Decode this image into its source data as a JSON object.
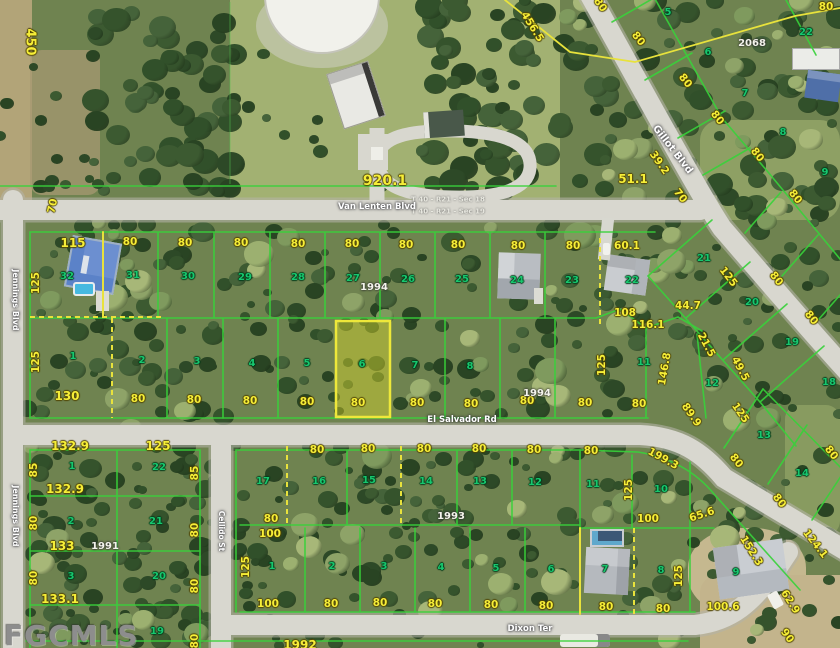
{
  "watermark": "FGCMLS",
  "colors": {
    "dimension": "#f6ee38",
    "lot_number": "#17c76e",
    "plat_line_green": "#38d23a",
    "plat_line_yellow": "#e8e23c",
    "road": "#d8d7cf",
    "highlight_fill": "#e1dc28"
  },
  "streets": [
    {
      "name": "Van Lenten Blvd",
      "labels": [
        {
          "x": 377,
          "y": 207,
          "r": 0,
          "s": 8.5
        }
      ]
    },
    {
      "name": "Gillot Blvd",
      "labels": [
        {
          "x": 672,
          "y": 150,
          "r": 52,
          "s": 10
        }
      ]
    },
    {
      "name": "Jennings Blvd",
      "labels": [
        {
          "x": 15,
          "y": 300,
          "r": 90,
          "s": 8
        },
        {
          "x": 15,
          "y": 516,
          "r": 90,
          "s": 8
        }
      ]
    },
    {
      "name": "Cellido St",
      "labels": [
        {
          "x": 221,
          "y": 531,
          "r": 90,
          "s": 7.5
        }
      ]
    },
    {
      "name": "El Salvador Rd",
      "labels": [
        {
          "x": 462,
          "y": 420,
          "r": 0,
          "s": 8.5
        }
      ]
    },
    {
      "name": "Dixon Ter",
      "labels": [
        {
          "x": 530,
          "y": 629,
          "r": 0,
          "s": 8.5
        }
      ]
    }
  ],
  "section_labels": [
    {
      "t": "T 40 - R21 - Sec 18",
      "x": 448,
      "y": 200
    },
    {
      "t": "T 40 - R21 - Sec 19",
      "x": 448,
      "y": 212
    }
  ],
  "plat_numbers": [
    {
      "t": "2068",
      "x": 752,
      "y": 44
    },
    {
      "t": "1994",
      "x": 374,
      "y": 288
    },
    {
      "t": "1994",
      "x": 537,
      "y": 394
    },
    {
      "t": "1993",
      "x": 451,
      "y": 517
    },
    {
      "t": "1991",
      "x": 105,
      "y": 547
    }
  ],
  "dimensions": [
    {
      "t": "450",
      "x": 30,
      "y": 42,
      "r": 90,
      "s": 13
    },
    {
      "t": "80",
      "x": 600,
      "y": 5,
      "r": 55
    },
    {
      "t": "80",
      "x": 826,
      "y": 7
    },
    {
      "t": "456.5",
      "x": 532,
      "y": 27,
      "r": 58
    },
    {
      "t": "920.1",
      "x": 385,
      "y": 181,
      "r": 0,
      "s": 14
    },
    {
      "t": "80",
      "x": 638,
      "y": 39,
      "r": 52
    },
    {
      "t": "80",
      "x": 685,
      "y": 81,
      "r": 52
    },
    {
      "t": "80",
      "x": 717,
      "y": 118,
      "r": 52
    },
    {
      "t": "80",
      "x": 757,
      "y": 155,
      "r": 52
    },
    {
      "t": "80",
      "x": 795,
      "y": 197,
      "r": 52
    },
    {
      "t": "39.2",
      "x": 659,
      "y": 163,
      "r": 55
    },
    {
      "t": "51.1",
      "x": 633,
      "y": 179,
      "s": 12
    },
    {
      "t": "70",
      "x": 680,
      "y": 196,
      "r": 52
    },
    {
      "t": "70",
      "x": 53,
      "y": 206,
      "r": -78
    },
    {
      "t": "115",
      "x": 73,
      "y": 243,
      "s": 12
    },
    {
      "t": "80",
      "x": 130,
      "y": 242
    },
    {
      "t": "80",
      "x": 185,
      "y": 243
    },
    {
      "t": "80",
      "x": 241,
      "y": 243
    },
    {
      "t": "80",
      "x": 298,
      "y": 244
    },
    {
      "t": "80",
      "x": 352,
      "y": 244
    },
    {
      "t": "80",
      "x": 406,
      "y": 245
    },
    {
      "t": "80",
      "x": 458,
      "y": 245
    },
    {
      "t": "80",
      "x": 518,
      "y": 246
    },
    {
      "t": "80",
      "x": 573,
      "y": 246
    },
    {
      "t": "60.1",
      "x": 627,
      "y": 246
    },
    {
      "t": "125",
      "x": 36,
      "y": 283,
      "r": -90
    },
    {
      "t": "125",
      "x": 36,
      "y": 362,
      "r": -90
    },
    {
      "t": "130",
      "x": 67,
      "y": 396,
      "s": 12
    },
    {
      "t": "80",
      "x": 138,
      "y": 399
    },
    {
      "t": "80",
      "x": 194,
      "y": 400
    },
    {
      "t": "80",
      "x": 250,
      "y": 401
    },
    {
      "t": "80",
      "x": 307,
      "y": 402
    },
    {
      "t": "80",
      "x": 358,
      "y": 403
    },
    {
      "t": "80",
      "x": 417,
      "y": 403
    },
    {
      "t": "80",
      "x": 471,
      "y": 404
    },
    {
      "t": "80",
      "x": 527,
      "y": 401
    },
    {
      "t": "80",
      "x": 585,
      "y": 403
    },
    {
      "t": "80",
      "x": 639,
      "y": 404
    },
    {
      "t": "108",
      "x": 625,
      "y": 313
    },
    {
      "t": "116.1",
      "x": 648,
      "y": 325
    },
    {
      "t": "44.7",
      "x": 688,
      "y": 306
    },
    {
      "t": "21.5",
      "x": 706,
      "y": 345,
      "r": 62
    },
    {
      "t": "125",
      "x": 728,
      "y": 277,
      "r": 52
    },
    {
      "t": "80",
      "x": 776,
      "y": 279,
      "r": 52
    },
    {
      "t": "49.5",
      "x": 740,
      "y": 369,
      "r": 62
    },
    {
      "t": "80",
      "x": 811,
      "y": 318,
      "r": 52
    },
    {
      "t": "125",
      "x": 602,
      "y": 365,
      "r": -90
    },
    {
      "t": "146.8",
      "x": 665,
      "y": 369,
      "r": -80
    },
    {
      "t": "89.9",
      "x": 691,
      "y": 415,
      "r": 55
    },
    {
      "t": "125",
      "x": 740,
      "y": 413,
      "r": 55
    },
    {
      "t": "132.9",
      "x": 70,
      "y": 446,
      "s": 12
    },
    {
      "t": "125",
      "x": 158,
      "y": 446,
      "s": 12
    },
    {
      "t": "85",
      "x": 34,
      "y": 470,
      "r": -90
    },
    {
      "t": "85",
      "x": 195,
      "y": 473,
      "r": -90
    },
    {
      "t": "132.9",
      "x": 65,
      "y": 489,
      "s": 12
    },
    {
      "t": "80",
      "x": 34,
      "y": 523,
      "r": -90
    },
    {
      "t": "80",
      "x": 195,
      "y": 530,
      "r": -90
    },
    {
      "t": "133",
      "x": 62,
      "y": 546,
      "s": 12
    },
    {
      "t": "80",
      "x": 34,
      "y": 578,
      "r": -90
    },
    {
      "t": "80",
      "x": 195,
      "y": 586,
      "r": -90
    },
    {
      "t": "133.1",
      "x": 60,
      "y": 599,
      "s": 12
    },
    {
      "t": "80",
      "x": 195,
      "y": 641,
      "r": -90
    },
    {
      "t": "80",
      "x": 317,
      "y": 450
    },
    {
      "t": "80",
      "x": 368,
      "y": 449
    },
    {
      "t": "80",
      "x": 424,
      "y": 449
    },
    {
      "t": "80",
      "x": 479,
      "y": 449
    },
    {
      "t": "80",
      "x": 534,
      "y": 450
    },
    {
      "t": "80",
      "x": 271,
      "y": 519
    },
    {
      "t": "100",
      "x": 270,
      "y": 534
    },
    {
      "t": "125",
      "x": 246,
      "y": 567,
      "r": -90
    },
    {
      "t": "100",
      "x": 268,
      "y": 604
    },
    {
      "t": "80",
      "x": 331,
      "y": 604
    },
    {
      "t": "80",
      "x": 380,
      "y": 603
    },
    {
      "t": "80",
      "x": 435,
      "y": 604
    },
    {
      "t": "80",
      "x": 491,
      "y": 605
    },
    {
      "t": "80",
      "x": 546,
      "y": 606
    },
    {
      "t": "1992",
      "x": 300,
      "y": 645,
      "s": 12
    },
    {
      "t": "80",
      "x": 591,
      "y": 451
    },
    {
      "t": "199.3",
      "x": 663,
      "y": 459,
      "r": 29
    },
    {
      "t": "125",
      "x": 629,
      "y": 490,
      "r": -90
    },
    {
      "t": "80",
      "x": 736,
      "y": 461,
      "r": 52
    },
    {
      "t": "80",
      "x": 779,
      "y": 501,
      "r": 52
    },
    {
      "t": "80",
      "x": 831,
      "y": 453,
      "r": 52
    },
    {
      "t": "100",
      "x": 648,
      "y": 519
    },
    {
      "t": "65.6",
      "x": 702,
      "y": 515,
      "r": -18
    },
    {
      "t": "124.1",
      "x": 815,
      "y": 544,
      "r": 52
    },
    {
      "t": "152.3",
      "x": 751,
      "y": 551,
      "r": 58
    },
    {
      "t": "125",
      "x": 679,
      "y": 576,
      "r": -90
    },
    {
      "t": "80",
      "x": 606,
      "y": 607
    },
    {
      "t": "80",
      "x": 663,
      "y": 609
    },
    {
      "t": "100.6",
      "x": 723,
      "y": 607
    },
    {
      "t": "62.9",
      "x": 790,
      "y": 602,
      "r": 58
    },
    {
      "t": "90",
      "x": 787,
      "y": 636,
      "r": 55
    }
  ],
  "lot_numbers": [
    {
      "t": "32",
      "x": 67,
      "y": 277
    },
    {
      "t": "31",
      "x": 133,
      "y": 276
    },
    {
      "t": "30",
      "x": 188,
      "y": 277
    },
    {
      "t": "29",
      "x": 245,
      "y": 278
    },
    {
      "t": "28",
      "x": 298,
      "y": 278
    },
    {
      "t": "27",
      "x": 353,
      "y": 279
    },
    {
      "t": "26",
      "x": 408,
      "y": 280
    },
    {
      "t": "25",
      "x": 462,
      "y": 280
    },
    {
      "t": "24",
      "x": 517,
      "y": 281
    },
    {
      "t": "23",
      "x": 572,
      "y": 281
    },
    {
      "t": "22",
      "x": 632,
      "y": 281
    },
    {
      "t": "1",
      "x": 73,
      "y": 357
    },
    {
      "t": "2",
      "x": 142,
      "y": 361
    },
    {
      "t": "3",
      "x": 197,
      "y": 362
    },
    {
      "t": "4",
      "x": 252,
      "y": 364
    },
    {
      "t": "5",
      "x": 307,
      "y": 364
    },
    {
      "t": "6",
      "x": 362,
      "y": 365
    },
    {
      "t": "7",
      "x": 415,
      "y": 366
    },
    {
      "t": "8",
      "x": 470,
      "y": 367
    },
    {
      "t": "21",
      "x": 704,
      "y": 259
    },
    {
      "t": "20",
      "x": 752,
      "y": 303
    },
    {
      "t": "19",
      "x": 792,
      "y": 343
    },
    {
      "t": "18",
      "x": 829,
      "y": 383
    },
    {
      "t": "11",
      "x": 644,
      "y": 363
    },
    {
      "t": "12",
      "x": 712,
      "y": 384
    },
    {
      "t": "5",
      "x": 668,
      "y": 13
    },
    {
      "t": "6",
      "x": 708,
      "y": 53
    },
    {
      "t": "7",
      "x": 745,
      "y": 94
    },
    {
      "t": "8",
      "x": 783,
      "y": 133
    },
    {
      "t": "9",
      "x": 825,
      "y": 173
    },
    {
      "t": "22",
      "x": 806,
      "y": 33
    },
    {
      "t": "1",
      "x": 72,
      "y": 467
    },
    {
      "t": "22",
      "x": 159,
      "y": 468
    },
    {
      "t": "2",
      "x": 71,
      "y": 522
    },
    {
      "t": "21",
      "x": 156,
      "y": 522
    },
    {
      "t": "3",
      "x": 71,
      "y": 577
    },
    {
      "t": "20",
      "x": 159,
      "y": 577
    },
    {
      "t": "19",
      "x": 157,
      "y": 632
    },
    {
      "t": "17",
      "x": 263,
      "y": 482
    },
    {
      "t": "16",
      "x": 319,
      "y": 482
    },
    {
      "t": "15",
      "x": 369,
      "y": 481
    },
    {
      "t": "14",
      "x": 426,
      "y": 482
    },
    {
      "t": "13",
      "x": 480,
      "y": 482
    },
    {
      "t": "12",
      "x": 535,
      "y": 483
    },
    {
      "t": "1",
      "x": 272,
      "y": 567
    },
    {
      "t": "2",
      "x": 332,
      "y": 567
    },
    {
      "t": "3",
      "x": 384,
      "y": 567
    },
    {
      "t": "4",
      "x": 441,
      "y": 568
    },
    {
      "t": "5",
      "x": 496,
      "y": 569
    },
    {
      "t": "6",
      "x": 551,
      "y": 570
    },
    {
      "t": "11",
      "x": 593,
      "y": 485
    },
    {
      "t": "10",
      "x": 661,
      "y": 490
    },
    {
      "t": "13",
      "x": 764,
      "y": 436
    },
    {
      "t": "14",
      "x": 802,
      "y": 474
    },
    {
      "t": "7",
      "x": 605,
      "y": 570
    },
    {
      "t": "8",
      "x": 661,
      "y": 571
    },
    {
      "t": "9",
      "x": 736,
      "y": 573
    }
  ],
  "highlighted_parcel": {
    "lot": "6",
    "x": 336,
    "y": 321,
    "w": 54,
    "h": 96
  }
}
